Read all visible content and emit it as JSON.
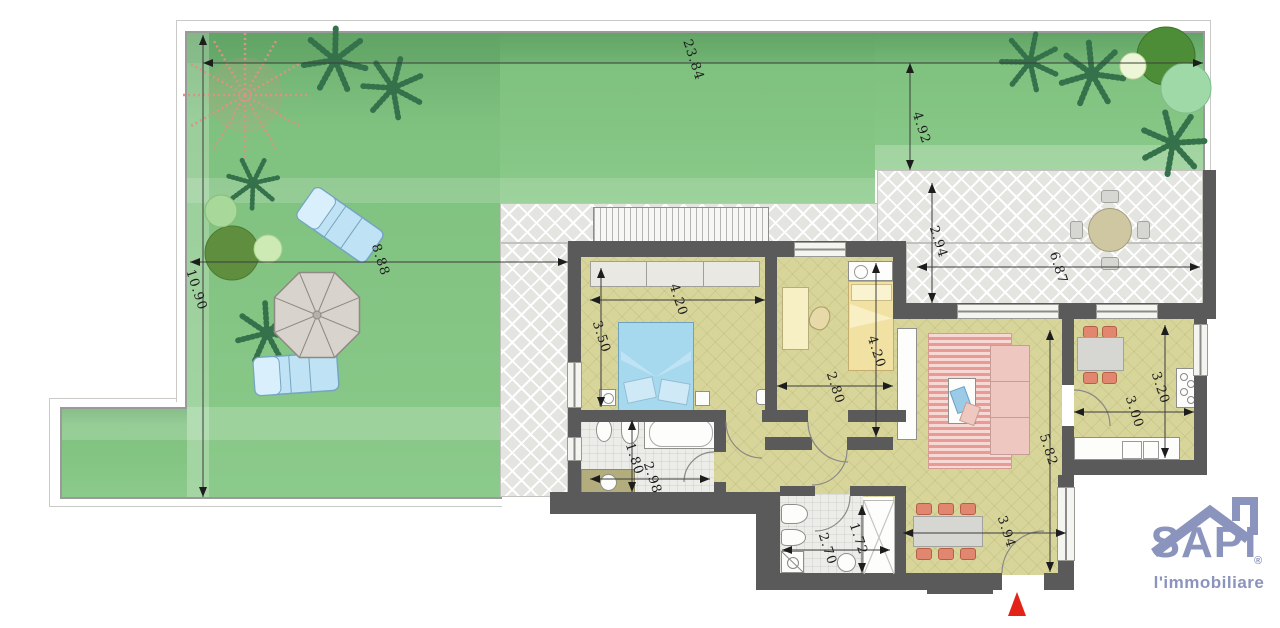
{
  "plan": {
    "dimensions": {
      "garden_top_width": "23.84",
      "garden_right_depth": "4.92",
      "garden_left_height": "10.90",
      "garden_mid_width": "8.88",
      "terrace_depth": "2.94",
      "terrace_width": "6.87",
      "bedroom_width": "4.20",
      "bedroom_depth": "3.50",
      "bedroom2_depth": "4.20",
      "bedroom2_width": "2.80",
      "bathroom_depth": "1.80",
      "bathroom_width": "2.98",
      "living_depth": "5.82",
      "kitchen_depth": "3.20",
      "kitchen_width": "3.00",
      "dining_width": "3.94",
      "bathroom2_width": "2.70",
      "bathroom2_depth": "1.72"
    },
    "logo": {
      "brand": "SAPI",
      "registered_mark": "®",
      "tagline": "l'immobiliare"
    },
    "colors": {
      "garden_green": "#7fc17f",
      "terrace_gray": "#e4e4e1",
      "wall_gray": "#5a5a5a",
      "floor_yellow": "#d8d59b",
      "bed_blue": "#a6d8ee",
      "sofa_pink": "#edc7c0",
      "chair_coral": "#e2876f",
      "logo_blue": "#8a94bc",
      "entrance_marker_red": "#e42318"
    }
  }
}
